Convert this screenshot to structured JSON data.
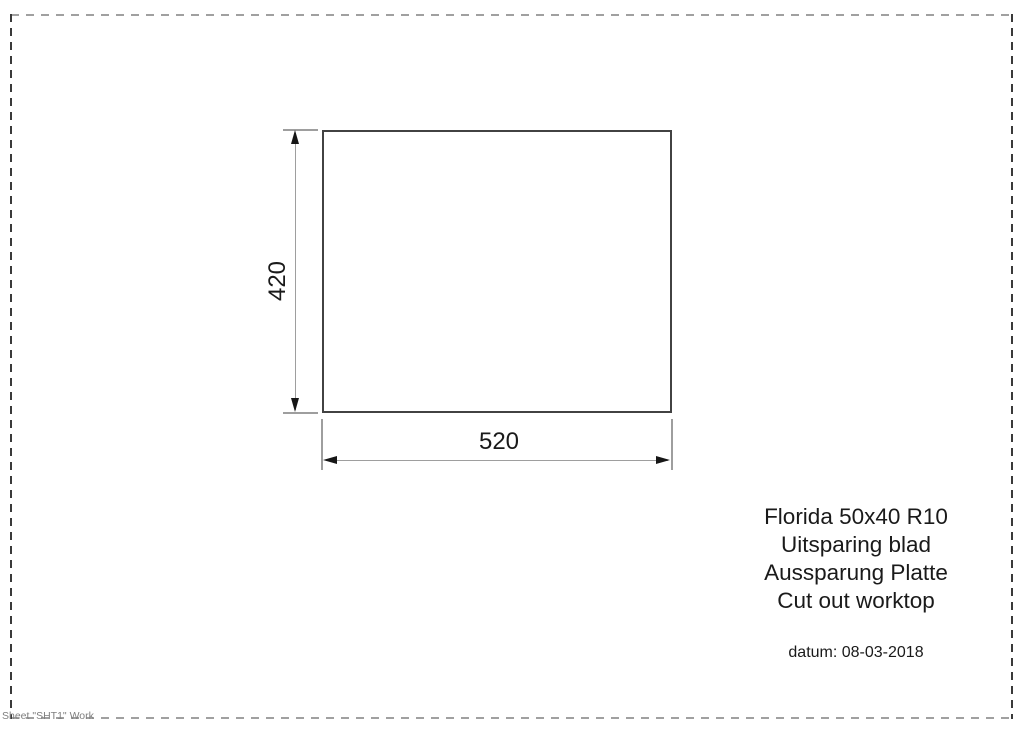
{
  "drawing": {
    "cutout": {
      "height_dimension": "420",
      "width_dimension": "520"
    },
    "title_block": {
      "line1": "Florida 50x40 R10",
      "line2": "Uitsparing blad",
      "line3": "Aussparung Platte",
      "line4": "Cut out worktop",
      "date": "datum: 08-03-2018"
    },
    "sheet_label": "Sheet \"SHT1\" Work",
    "colors": {
      "outline": "#424242",
      "dimension_line": "#9e9e9e",
      "arrow": "#161616",
      "text": "#1a1a1a",
      "border_dash_horizontal": "#a0a0a0",
      "border_dash_vertical": "#3a3a3a",
      "sheet_text": "#808080"
    }
  }
}
